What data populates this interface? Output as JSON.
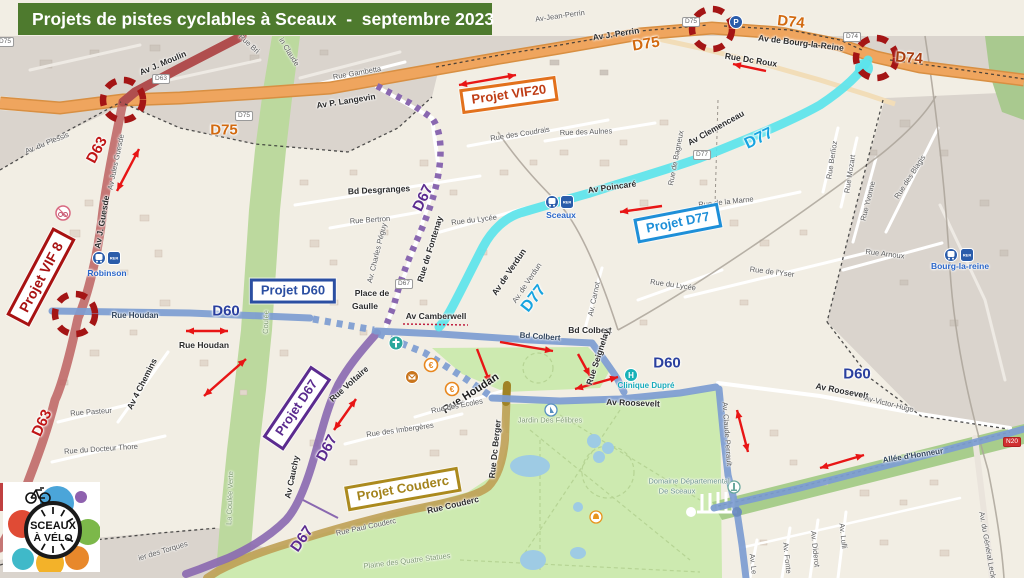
{
  "title": "Projets de pistes cyclables à Sceaux  -  septembre 2023",
  "logo": {
    "top": "SCEAUX",
    "bottom": "À VÉLO"
  },
  "colors": {
    "title_bg": "#4e7a2e",
    "d63_red": "#bd6262",
    "d75_orange": "#efa55e",
    "d77_cyan": "#5ce4ec",
    "d60_blue": "#7d9dd2",
    "d67_purple": "#8a68b0",
    "couderc_gold": "#bfa055",
    "alert_red": "#a41515",
    "arrow_red": "#e81515",
    "park_green": "#cdeab0",
    "outside_gray": "#dad4cd"
  },
  "projects": [
    {
      "label": "Projet VIF20",
      "x": 509,
      "y": 95,
      "rot": -8,
      "theme": "orange"
    },
    {
      "label": "Projet D77",
      "x": 678,
      "y": 223,
      "rot": -11,
      "theme": "cyan"
    },
    {
      "label": "Projet D60",
      "x": 293,
      "y": 291,
      "rot": 0,
      "theme": "blue"
    },
    {
      "label": "Projet VIF 8",
      "x": 41,
      "y": 277,
      "rot": -62,
      "theme": "darkred"
    },
    {
      "label": "Projet D67",
      "x": 297,
      "y": 408,
      "rot": -56,
      "theme": "purple"
    },
    {
      "label": "Projet Couderc",
      "x": 403,
      "y": 489,
      "rot": -10,
      "theme": "gold"
    }
  ],
  "map": {
    "labels": [
      {
        "t": "Av J. Moulin",
        "x": 163,
        "y": 63,
        "r": -23,
        "c": "st"
      },
      {
        "t": "Rue Bri",
        "x": 249,
        "y": 44,
        "r": 42,
        "c": "sts"
      },
      {
        "t": "in Claude",
        "x": 289,
        "y": 52,
        "r": 58,
        "c": "sts"
      },
      {
        "t": "Rue Gambetta",
        "x": 357,
        "y": 73,
        "r": -10,
        "c": "sts"
      },
      {
        "t": "Av P. Langevin",
        "x": 346,
        "y": 101,
        "r": -9,
        "c": "st"
      },
      {
        "t": "Av-Jean-Perrin",
        "x": 560,
        "y": 16,
        "r": -8,
        "c": "sts"
      },
      {
        "t": "Av J. Perrin",
        "x": 616,
        "y": 34,
        "r": -9,
        "c": "st"
      },
      {
        "t": "Av de Bourg-la-Reine",
        "x": 801,
        "y": 43,
        "r": 7,
        "c": "st"
      },
      {
        "t": "Rue Dc Roux",
        "x": 751,
        "y": 60,
        "r": 9,
        "c": "st"
      },
      {
        "t": "D75",
        "x": 224,
        "y": 130,
        "r": 0,
        "c": "ro"
      },
      {
        "t": "D75",
        "x": 646,
        "y": 44,
        "r": -9,
        "c": "ro"
      },
      {
        "t": "D74",
        "x": 791,
        "y": 22,
        "r": 6,
        "c": "ro"
      },
      {
        "t": "D74",
        "x": 909,
        "y": 58,
        "r": 4,
        "c": "rdo"
      },
      {
        "t": "D63",
        "x": 97,
        "y": 150,
        "r": -62,
        "c": "rr"
      },
      {
        "t": "D63",
        "x": 42,
        "y": 423,
        "r": -65,
        "c": "rr"
      },
      {
        "t": "D77",
        "x": 534,
        "y": 299,
        "r": -52,
        "c": "rc"
      },
      {
        "t": "D77",
        "x": 759,
        "y": 139,
        "r": -26,
        "c": "rc"
      },
      {
        "t": "D60",
        "x": 226,
        "y": 311,
        "r": 0,
        "c": "rb"
      },
      {
        "t": "D60",
        "x": 667,
        "y": 363,
        "r": 0,
        "c": "rb"
      },
      {
        "t": "D60",
        "x": 857,
        "y": 374,
        "r": 0,
        "c": "rb"
      },
      {
        "t": "D67",
        "x": 423,
        "y": 198,
        "r": -64,
        "c": "rp"
      },
      {
        "t": "D67",
        "x": 327,
        "y": 448,
        "r": -62,
        "c": "rp"
      },
      {
        "t": "D67",
        "x": 302,
        "y": 539,
        "r": -55,
        "c": "rp"
      },
      {
        "t": "Av. du Plessis",
        "x": 47,
        "y": 143,
        "r": -22,
        "c": "sts"
      },
      {
        "t": "Av Jules Guesde",
        "x": 116,
        "y": 162,
        "r": -78,
        "c": "sts"
      },
      {
        "t": "Av J. Guesde",
        "x": 102,
        "y": 222,
        "r": -80,
        "c": "st"
      },
      {
        "t": "Bd Desgranges",
        "x": 379,
        "y": 190,
        "r": -3,
        "c": "st"
      },
      {
        "t": "Rue Bertron",
        "x": 370,
        "y": 220,
        "r": -4,
        "c": "sts"
      },
      {
        "t": "Rue de Fontenay",
        "x": 430,
        "y": 249,
        "r": -73,
        "c": "st"
      },
      {
        "t": "Av. Charles Péguy",
        "x": 377,
        "y": 253,
        "r": -76,
        "c": "sts"
      },
      {
        "t": "Rue du Lycée",
        "x": 474,
        "y": 220,
        "r": -7,
        "c": "sts"
      },
      {
        "t": "Rue des Coudrais",
        "x": 520,
        "y": 134,
        "r": -9,
        "c": "sts"
      },
      {
        "t": "Rue des Aulnes",
        "x": 586,
        "y": 132,
        "r": -2,
        "c": "sts"
      },
      {
        "t": "Av Poincaré",
        "x": 612,
        "y": 187,
        "r": -8,
        "c": "st"
      },
      {
        "t": "Av Clemenceau",
        "x": 716,
        "y": 128,
        "r": -29,
        "c": "st"
      },
      {
        "t": "Rue de Bagneux",
        "x": 676,
        "y": 158,
        "r": -79,
        "c": "sts"
      },
      {
        "t": "Rue de la Marne",
        "x": 726,
        "y": 202,
        "r": -6,
        "c": "sts"
      },
      {
        "t": "Rue Berlioz",
        "x": 832,
        "y": 160,
        "r": -81,
        "c": "sts"
      },
      {
        "t": "Rue Mozart",
        "x": 850,
        "y": 174,
        "r": -81,
        "c": "sts"
      },
      {
        "t": "Rue Yvonne",
        "x": 868,
        "y": 201,
        "r": -76,
        "c": "sts"
      },
      {
        "t": "Rue des Blagis",
        "x": 910,
        "y": 177,
        "r": -57,
        "c": "sts"
      },
      {
        "t": "Rue Arnoux",
        "x": 885,
        "y": 254,
        "r": 7,
        "c": "sts"
      },
      {
        "t": "Rue de l'Yser",
        "x": 772,
        "y": 272,
        "r": 7,
        "c": "sts"
      },
      {
        "t": "Rue du Lycée",
        "x": 673,
        "y": 285,
        "r": 8,
        "c": "sts"
      },
      {
        "t": "Av. Carnot",
        "x": 594,
        "y": 299,
        "r": -78,
        "c": "sts"
      },
      {
        "t": "Av de Verdun",
        "x": 509,
        "y": 272,
        "r": -56,
        "c": "st"
      },
      {
        "t": "Av. de Verdun",
        "x": 527,
        "y": 283,
        "r": -56,
        "c": "sts"
      },
      {
        "t": "Rue Houdan",
        "x": 135,
        "y": 316,
        "r": 0,
        "c": "son"
      },
      {
        "t": "Rue Houdan",
        "x": 204,
        "y": 345,
        "r": 0,
        "c": "st"
      },
      {
        "t": "Av 4 Chemins",
        "x": 142,
        "y": 384,
        "r": -63,
        "c": "st"
      },
      {
        "t": "Rue Pasteur",
        "x": 91,
        "y": 412,
        "r": -4,
        "c": "sts"
      },
      {
        "t": "Rue du Docteur Thore",
        "x": 101,
        "y": 449,
        "r": -4,
        "c": "sts"
      },
      {
        "t": "Place de",
        "x": 372,
        "y": 293,
        "r": 0,
        "c": "st"
      },
      {
        "t": "Gaulle",
        "x": 365,
        "y": 306,
        "r": 0,
        "c": "st"
      },
      {
        "t": "Av Camberwell",
        "x": 436,
        "y": 316,
        "r": 0,
        "c": "st"
      },
      {
        "t": "Rue Voltaire",
        "x": 349,
        "y": 384,
        "r": -42,
        "c": "st"
      },
      {
        "t": "Bd Colbert",
        "x": 540,
        "y": 337,
        "r": 4,
        "c": "son"
      },
      {
        "t": "Bd Colbert",
        "x": 590,
        "y": 330,
        "r": 0,
        "c": "st"
      },
      {
        "t": "Rue Seignelay",
        "x": 598,
        "y": 357,
        "r": -72,
        "c": "st"
      },
      {
        "t": "Rue Houdan",
        "x": 471,
        "y": 394,
        "r": -33,
        "c": "stb"
      },
      {
        "t": "Rue des Écoles",
        "x": 457,
        "y": 406,
        "r": -11,
        "c": "sts"
      },
      {
        "t": "Rue des Imbergères",
        "x": 400,
        "y": 430,
        "r": -8,
        "c": "sts"
      },
      {
        "t": "Av Cauchy",
        "x": 292,
        "y": 477,
        "r": -78,
        "c": "st"
      },
      {
        "t": "Rue Dc Berger",
        "x": 495,
        "y": 449,
        "r": -84,
        "c": "st"
      },
      {
        "t": "Rue Couderc",
        "x": 453,
        "y": 505,
        "r": -13,
        "c": "st"
      },
      {
        "t": "Rue Paul Couderc",
        "x": 366,
        "y": 527,
        "r": -12,
        "c": "sts"
      },
      {
        "t": "Av Roosevelt",
        "x": 633,
        "y": 403,
        "r": 2,
        "c": "st"
      },
      {
        "t": "Av Roosevelt",
        "x": 842,
        "y": 391,
        "r": 11,
        "c": "st"
      },
      {
        "t": "Av-Victor-Hugo",
        "x": 889,
        "y": 404,
        "r": 14,
        "c": "sts"
      },
      {
        "t": "Allée d'Honneur",
        "x": 913,
        "y": 456,
        "r": -9,
        "c": "son"
      },
      {
        "t": "Av. Claude Perrault",
        "x": 727,
        "y": 434,
        "r": 86,
        "c": "sts"
      },
      {
        "t": "Av. Le",
        "x": 753,
        "y": 564,
        "r": 84,
        "c": "sts"
      },
      {
        "t": "Av. Fonte",
        "x": 787,
        "y": 558,
        "r": 84,
        "c": "sts"
      },
      {
        "t": "Av. Diderot",
        "x": 815,
        "y": 549,
        "r": 84,
        "c": "sts"
      },
      {
        "t": "Av. Lulli",
        "x": 843,
        "y": 536,
        "r": 84,
        "c": "sts"
      },
      {
        "t": "Av. du Général Leclerc",
        "x": 988,
        "y": 549,
        "r": 80,
        "c": "sts"
      },
      {
        "t": "Plaine des Quatre Statues",
        "x": 407,
        "y": 561,
        "r": -7,
        "c": "ar"
      },
      {
        "t": "La Coulée Verte",
        "x": 230,
        "y": 498,
        "r": -88,
        "c": "ar"
      },
      {
        "t": "Coulée",
        "x": 266,
        "y": 322,
        "r": -88,
        "c": "ar"
      },
      {
        "t": "Jardin Des Félibres",
        "x": 550,
        "y": 420,
        "r": 0,
        "c": "ar"
      },
      {
        "t": "Domaine Départemental",
        "x": 689,
        "y": 481,
        "r": 0,
        "c": "art"
      },
      {
        "t": "De Sceaux",
        "x": 677,
        "y": 491,
        "r": 0,
        "c": "art"
      },
      {
        "t": "ier des Torques",
        "x": 163,
        "y": 551,
        "r": -17,
        "c": "sts"
      },
      {
        "t": "Robinson",
        "x": 107,
        "y": 273,
        "r": 0,
        "c": "stn"
      },
      {
        "t": "Sceaux",
        "x": 561,
        "y": 215,
        "r": 0,
        "c": "stn"
      },
      {
        "t": "Bourg-la-reine",
        "x": 960,
        "y": 266,
        "r": 0,
        "c": "stn"
      },
      {
        "t": "Clinique Dupré",
        "x": 646,
        "y": 386,
        "r": 0,
        "c": "stt"
      }
    ],
    "shields": [
      {
        "t": "D63",
        "x": 161,
        "y": 79
      },
      {
        "t": "D75",
        "x": 244,
        "y": 116
      },
      {
        "t": "D75",
        "x": 5,
        "y": 42
      },
      {
        "t": "D75",
        "x": 691,
        "y": 22
      },
      {
        "t": "D74",
        "x": 852,
        "y": 37
      },
      {
        "t": "D77",
        "x": 702,
        "y": 155
      },
      {
        "t": "D67",
        "x": 404,
        "y": 284
      },
      {
        "t": "N20",
        "x": 1012,
        "y": 442,
        "red": true
      }
    ],
    "junction_circles": [
      {
        "x": 123,
        "y": 100
      },
      {
        "x": 75,
        "y": 314
      },
      {
        "x": 712,
        "y": 29
      },
      {
        "x": 876,
        "y": 58
      }
    ],
    "arrows": [
      {
        "x1": 117,
        "y1": 191,
        "x2": 139,
        "y2": 149,
        "h": 2
      },
      {
        "x1": 459,
        "y1": 85,
        "x2": 516,
        "y2": 75,
        "h": 2
      },
      {
        "x1": 766,
        "y1": 71,
        "x2": 733,
        "y2": 64,
        "h": 1
      },
      {
        "x1": 662,
        "y1": 206,
        "x2": 620,
        "y2": 212,
        "h": 1
      },
      {
        "x1": 204,
        "y1": 396,
        "x2": 246,
        "y2": 359,
        "h": 2
      },
      {
        "x1": 186,
        "y1": 331,
        "x2": 228,
        "y2": 331,
        "h": 2
      },
      {
        "x1": 500,
        "y1": 342,
        "x2": 553,
        "y2": 351,
        "h": 1
      },
      {
        "x1": 477,
        "y1": 349,
        "x2": 490,
        "y2": 383,
        "h": 1
      },
      {
        "x1": 578,
        "y1": 354,
        "x2": 590,
        "y2": 376,
        "h": 1
      },
      {
        "x1": 575,
        "y1": 389,
        "x2": 618,
        "y2": 377,
        "h": 2
      },
      {
        "x1": 737,
        "y1": 410,
        "x2": 748,
        "y2": 452,
        "h": 2
      },
      {
        "x1": 820,
        "y1": 468,
        "x2": 864,
        "y2": 455,
        "h": 2
      },
      {
        "x1": 334,
        "y1": 430,
        "x2": 356,
        "y2": 399,
        "h": 2
      }
    ],
    "icons": [
      {
        "t": "train",
        "x": 99,
        "y": 258
      },
      {
        "t": "rer",
        "x": 114,
        "y": 258
      },
      {
        "t": "train",
        "x": 552,
        "y": 202
      },
      {
        "t": "rer",
        "x": 567,
        "y": 202
      },
      {
        "t": "train",
        "x": 951,
        "y": 255
      },
      {
        "t": "rer",
        "x": 967,
        "y": 255
      },
      {
        "t": "church",
        "x": 396,
        "y": 343
      },
      {
        "t": "euro",
        "x": 431,
        "y": 365
      },
      {
        "t": "post",
        "x": 412,
        "y": 377
      },
      {
        "t": "euro",
        "x": 452,
        "y": 389
      },
      {
        "t": "hospital",
        "x": 631,
        "y": 375
      },
      {
        "t": "sail",
        "x": 551,
        "y": 410
      },
      {
        "t": "monument",
        "x": 734,
        "y": 487
      },
      {
        "t": "bell",
        "x": 596,
        "y": 517
      },
      {
        "t": "parking",
        "x": 736,
        "y": 22
      },
      {
        "t": "nobike",
        "x": 63,
        "y": 213
      }
    ]
  }
}
